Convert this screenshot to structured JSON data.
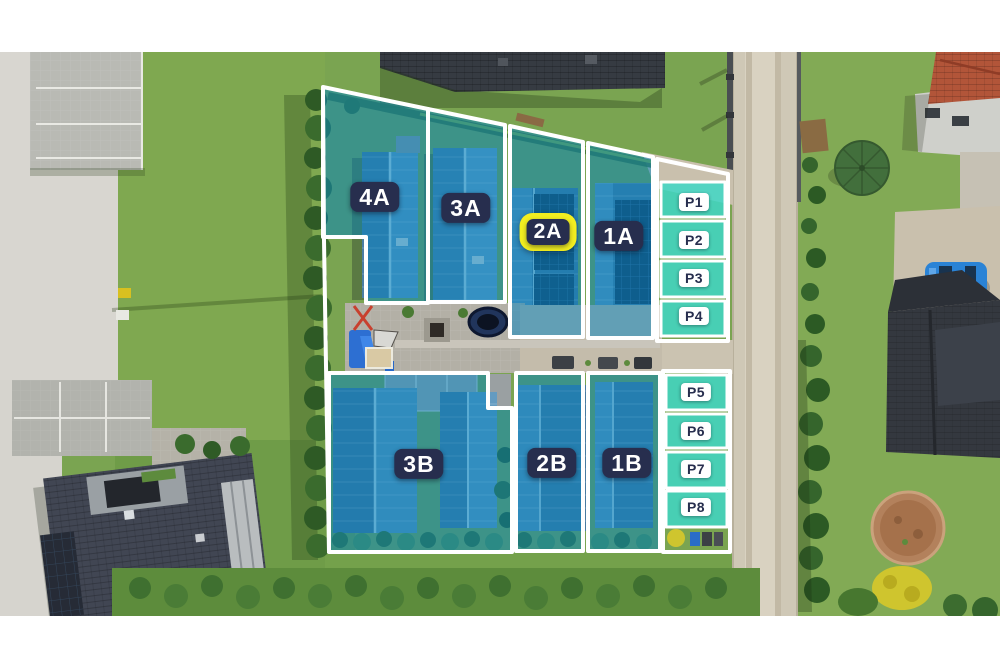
{
  "site_plan": {
    "units": [
      {
        "label": "4A",
        "row": "A",
        "highlighted": false
      },
      {
        "label": "3A",
        "row": "A",
        "highlighted": false
      },
      {
        "label": "2A",
        "row": "A",
        "highlighted": true
      },
      {
        "label": "1A",
        "row": "A",
        "highlighted": false
      },
      {
        "label": "3B",
        "row": "B",
        "highlighted": false
      },
      {
        "label": "2B",
        "row": "B",
        "highlighted": false
      },
      {
        "label": "1B",
        "row": "B",
        "highlighted": false
      }
    ],
    "parking_spaces": [
      {
        "label": "P1"
      },
      {
        "label": "P2"
      },
      {
        "label": "P3"
      },
      {
        "label": "P4"
      },
      {
        "label": "P5"
      },
      {
        "label": "P6"
      },
      {
        "label": "P7"
      },
      {
        "label": "P8"
      }
    ],
    "highlighted_unit": "2A",
    "colors": {
      "plot_overlay": "#0082c0",
      "parking_overlay": "#3fd7c6",
      "label_background": "#272e4e",
      "label_text": "#ffffff",
      "highlight_yellow": "#f2ee20",
      "outline": "#ffffff"
    }
  }
}
